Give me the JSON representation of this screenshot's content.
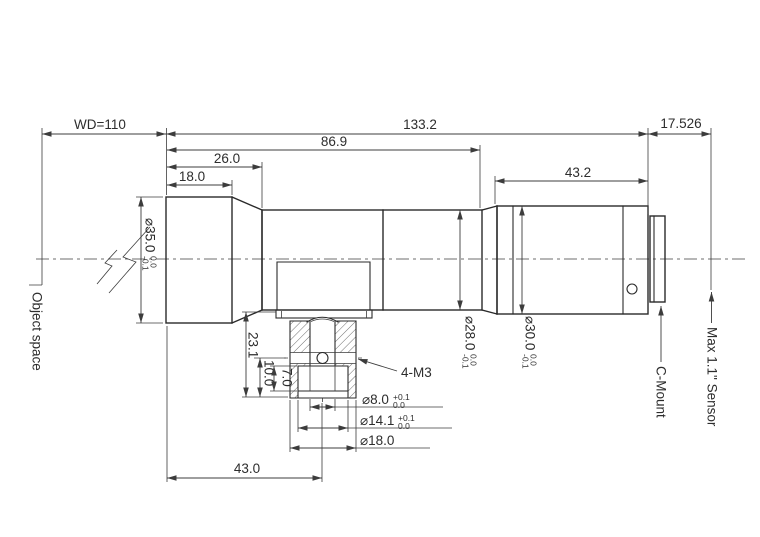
{
  "drawing": {
    "labels": {
      "object_space": "Object space",
      "c_mount": "C-Mount",
      "max_sensor": "Max 1.1\" Sensor",
      "thread_callout": "4-M3"
    },
    "dims": {
      "wd": "WD=110",
      "overall_length": "133.2",
      "body_length": "86.9",
      "front_length": "26.0",
      "front_cyl_length": "18.0",
      "rear_barrel_length": "43.2",
      "flange_distance": "17.526",
      "mount_offset": "43.0",
      "clamp_height": "23.1",
      "screw_height": "10.0",
      "recess_depth": "7.0",
      "dia_front": {
        "main": "⌀35.0",
        "sup": "0.0",
        "sub": "-0.1"
      },
      "dia_mid": {
        "main": "⌀28.0",
        "sup": "0.0",
        "sub": "-0.1"
      },
      "dia_rear": {
        "main": "⌀30.0",
        "sup": "0.0",
        "sub": "-0.1"
      },
      "dia_bore": {
        "main": "⌀8.0",
        "sup": "+0.1",
        "sub": "0.0"
      },
      "dia_counterbore": {
        "main": "⌀14.1",
        "sup": "+0.1",
        "sub": "0.0"
      },
      "dia_foot": "⌀18.0"
    },
    "colors": {
      "line": "#2a2a2a",
      "dim": "#3c3c3c",
      "background": "#ffffff"
    }
  }
}
